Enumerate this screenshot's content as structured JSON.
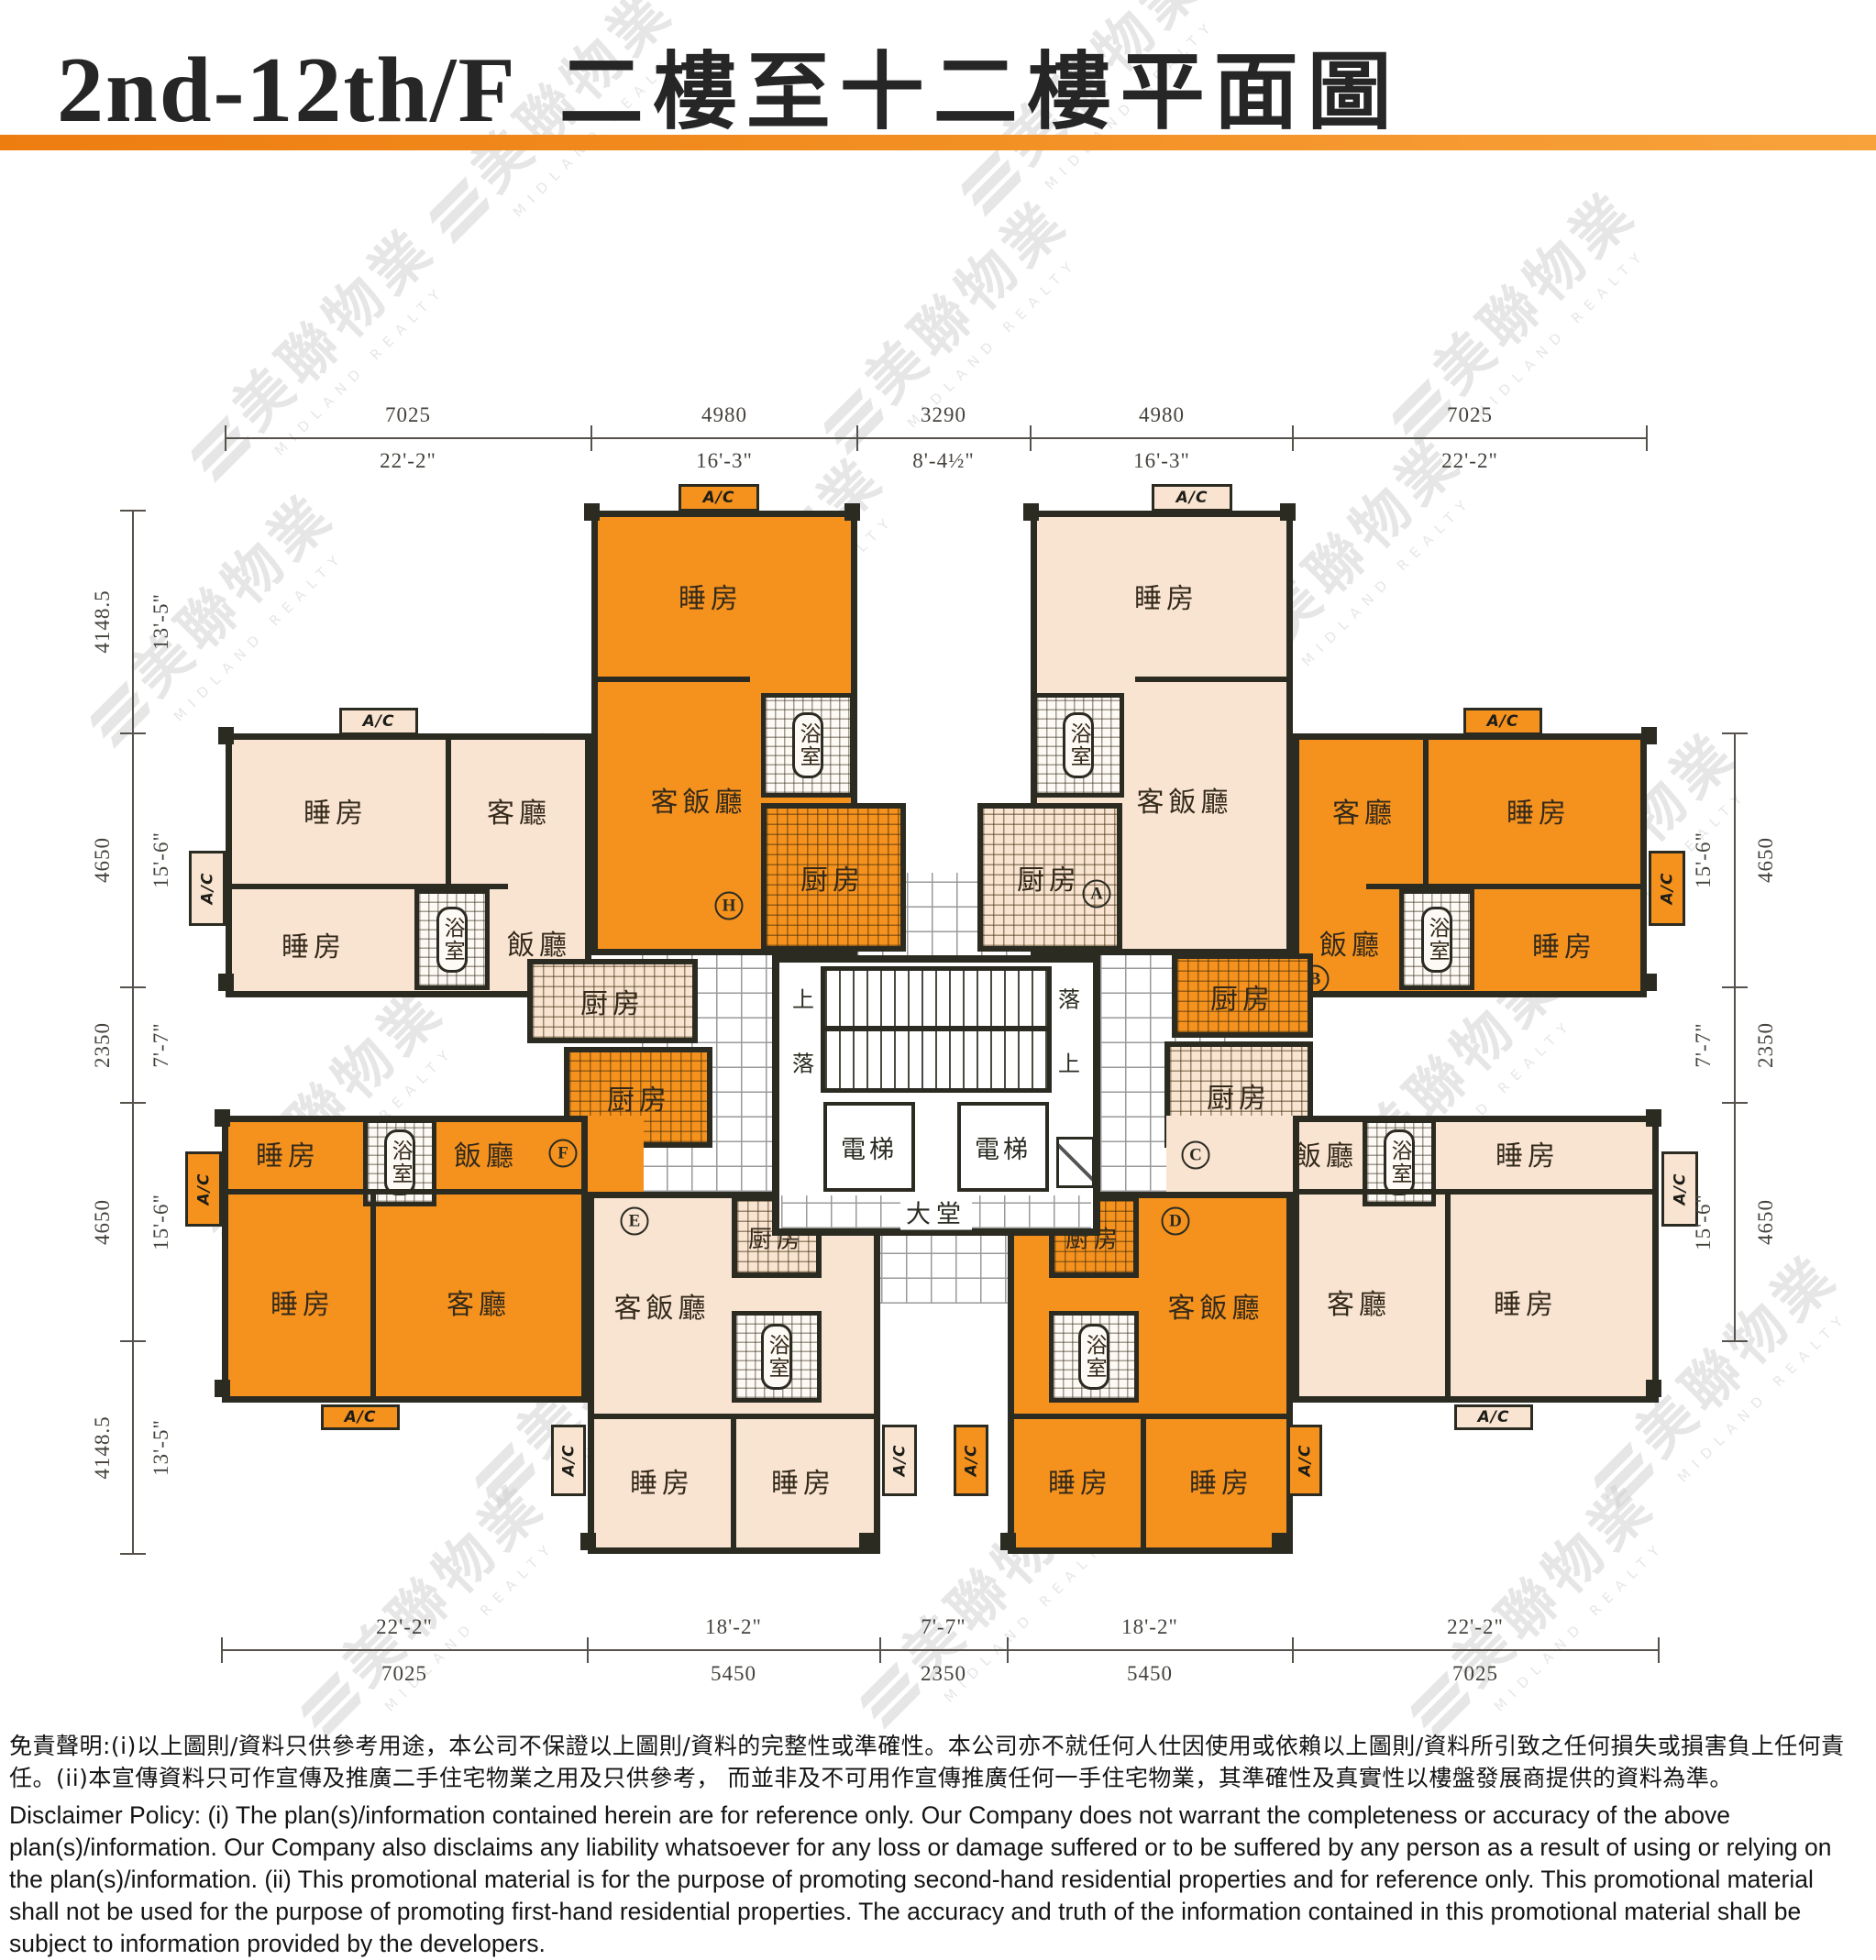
{
  "header": {
    "title_en": "2nd-12th/F",
    "title_zh": "二樓至十二樓平面圖"
  },
  "watermark": {
    "zh": "美聯物業",
    "en": "MIDLAND REALTY"
  },
  "plan": {
    "ac": "A/C",
    "rooms": {
      "bedroom": "睡房",
      "living": "客廳",
      "dining": "飯廳",
      "living_dining": "客飯廳",
      "bath": "浴室",
      "kitchen": "厨房"
    },
    "core": {
      "lift": "電梯",
      "lobby": "大堂",
      "up": "上",
      "down": "落"
    },
    "units": [
      {
        "letter": "A"
      },
      {
        "letter": "B"
      },
      {
        "letter": "C"
      },
      {
        "letter": "D"
      },
      {
        "letter": "E"
      },
      {
        "letter": "F"
      },
      {
        "letter": "G"
      },
      {
        "letter": "H"
      }
    ]
  },
  "dimensions": {
    "top": [
      {
        "mm": "7025",
        "ft": "22'-2\""
      },
      {
        "mm": "4980",
        "ft": "16'-3\""
      },
      {
        "mm": "3290",
        "ft": "8'-4½\""
      },
      {
        "mm": "4980",
        "ft": "16'-3\""
      },
      {
        "mm": "7025",
        "ft": "22'-2\""
      }
    ],
    "bottom": [
      {
        "mm": "7025",
        "ft": "22'-2\""
      },
      {
        "mm": "5450",
        "ft": "18'-2\""
      },
      {
        "mm": "2350",
        "ft": "7'-7\""
      },
      {
        "mm": "5450",
        "ft": "18'-2\""
      },
      {
        "mm": "7025",
        "ft": "22'-2\""
      }
    ],
    "left": [
      {
        "mm": "4148.5",
        "ft": "13'-5\""
      },
      {
        "mm": "4650",
        "ft": "15'-6\""
      },
      {
        "mm": "2350",
        "ft": "7'-7\""
      },
      {
        "mm": "4650",
        "ft": "15'-6\""
      },
      {
        "mm": "4148.5",
        "ft": "13'-5\""
      }
    ],
    "right": [
      {
        "mm": "4650",
        "ft": "15'-6\""
      },
      {
        "mm": "2350",
        "ft": "7'-7\""
      },
      {
        "mm": "4650",
        "ft": "15'-6\""
      }
    ]
  },
  "disclaimer": {
    "zh": "免責聲明:(i)以上圖則/資料只供參考用途，本公司不保證以上圖則/資料的完整性或準確性。本公司亦不就任何人仕因使用或依賴以上圖則/資料所引致之任何損失或損害負上任何責任。(ii)本宣傳資料只可作宣傳及推廣二手住宅物業之用及只供參考， 而並非及不可用作宣傳推廣任何一手住宅物業，其準確性及真實性以樓盤發展商提供的資料為準。",
    "en": "Disclaimer Policy: (i) The plan(s)/information contained herein are for reference only. Our Company does not warrant the completeness or accuracy of the above plan(s)/information. Our Company also disclaims any liability whatsoever for any loss or damage suffered or to be suffered by any person as a result of using or relying on the plan(s)/information. (ii) This promotional material is for the purpose of promoting second-hand residential properties and for reference only. This promotional material shall not be used for the purpose of promoting first-hand residential properties. The accuracy and truth of the information contained in this promotional material shall be subject to information provided by the developers."
  }
}
